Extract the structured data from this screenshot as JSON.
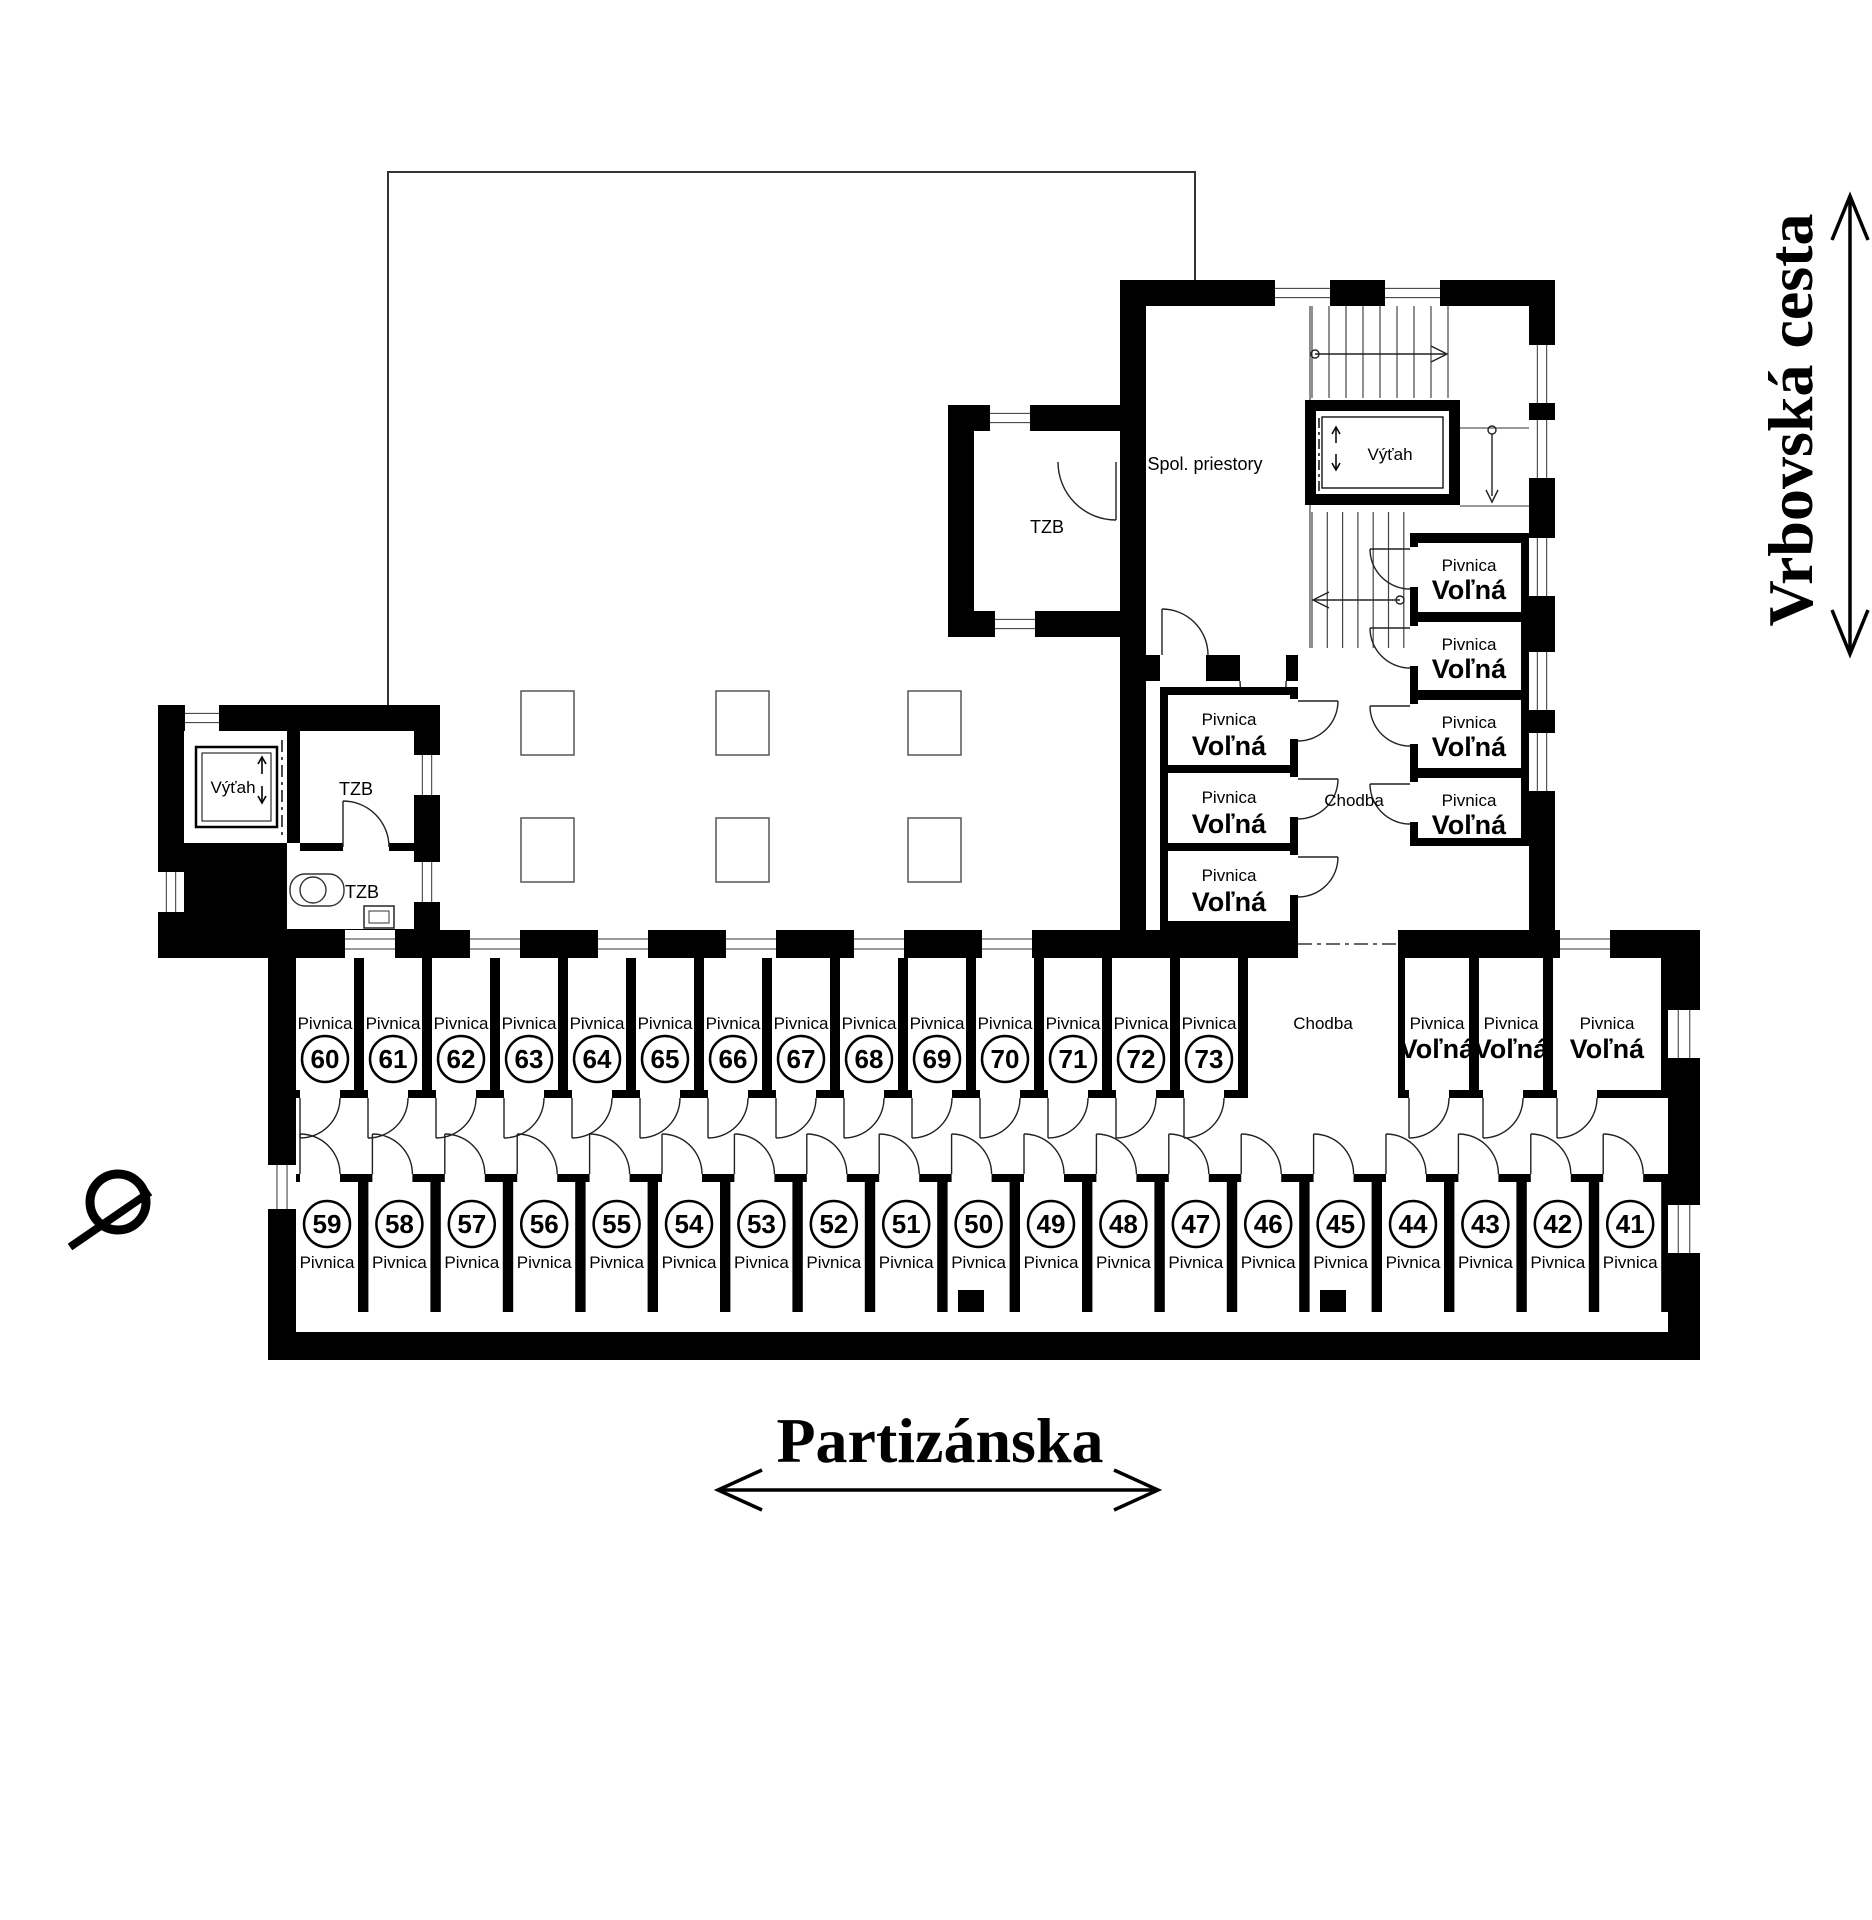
{
  "document": {
    "type": "basement-floor-plan"
  },
  "streets": {
    "bottom": "Partizánska",
    "right": "Vrbovská cesta"
  },
  "labels": {
    "cellar": "Pivnica",
    "free": "Voľná",
    "corridor": "Chodba",
    "elevator": "Výťah",
    "utility": "TZB",
    "common_areas": "Spol. priestory"
  },
  "strip_middle_row": {
    "numbers": [
      "60",
      "61",
      "62",
      "63",
      "64",
      "65",
      "66",
      "67",
      "68",
      "69",
      "70",
      "71",
      "72",
      "73"
    ]
  },
  "strip_bottom_row": {
    "numbers": [
      "59",
      "58",
      "57",
      "56",
      "55",
      "54",
      "53",
      "52",
      "51",
      "50",
      "49",
      "48",
      "47",
      "46",
      "45",
      "44",
      "43",
      "42",
      "41"
    ]
  },
  "strip_free_rooms": {
    "count": 3
  },
  "tower_left_free_rooms": {
    "count": 3
  },
  "tower_right_free_rooms": {
    "count": 4
  },
  "colors": {
    "wall": "#000000",
    "background": "#ffffff",
    "line": "#222222"
  }
}
